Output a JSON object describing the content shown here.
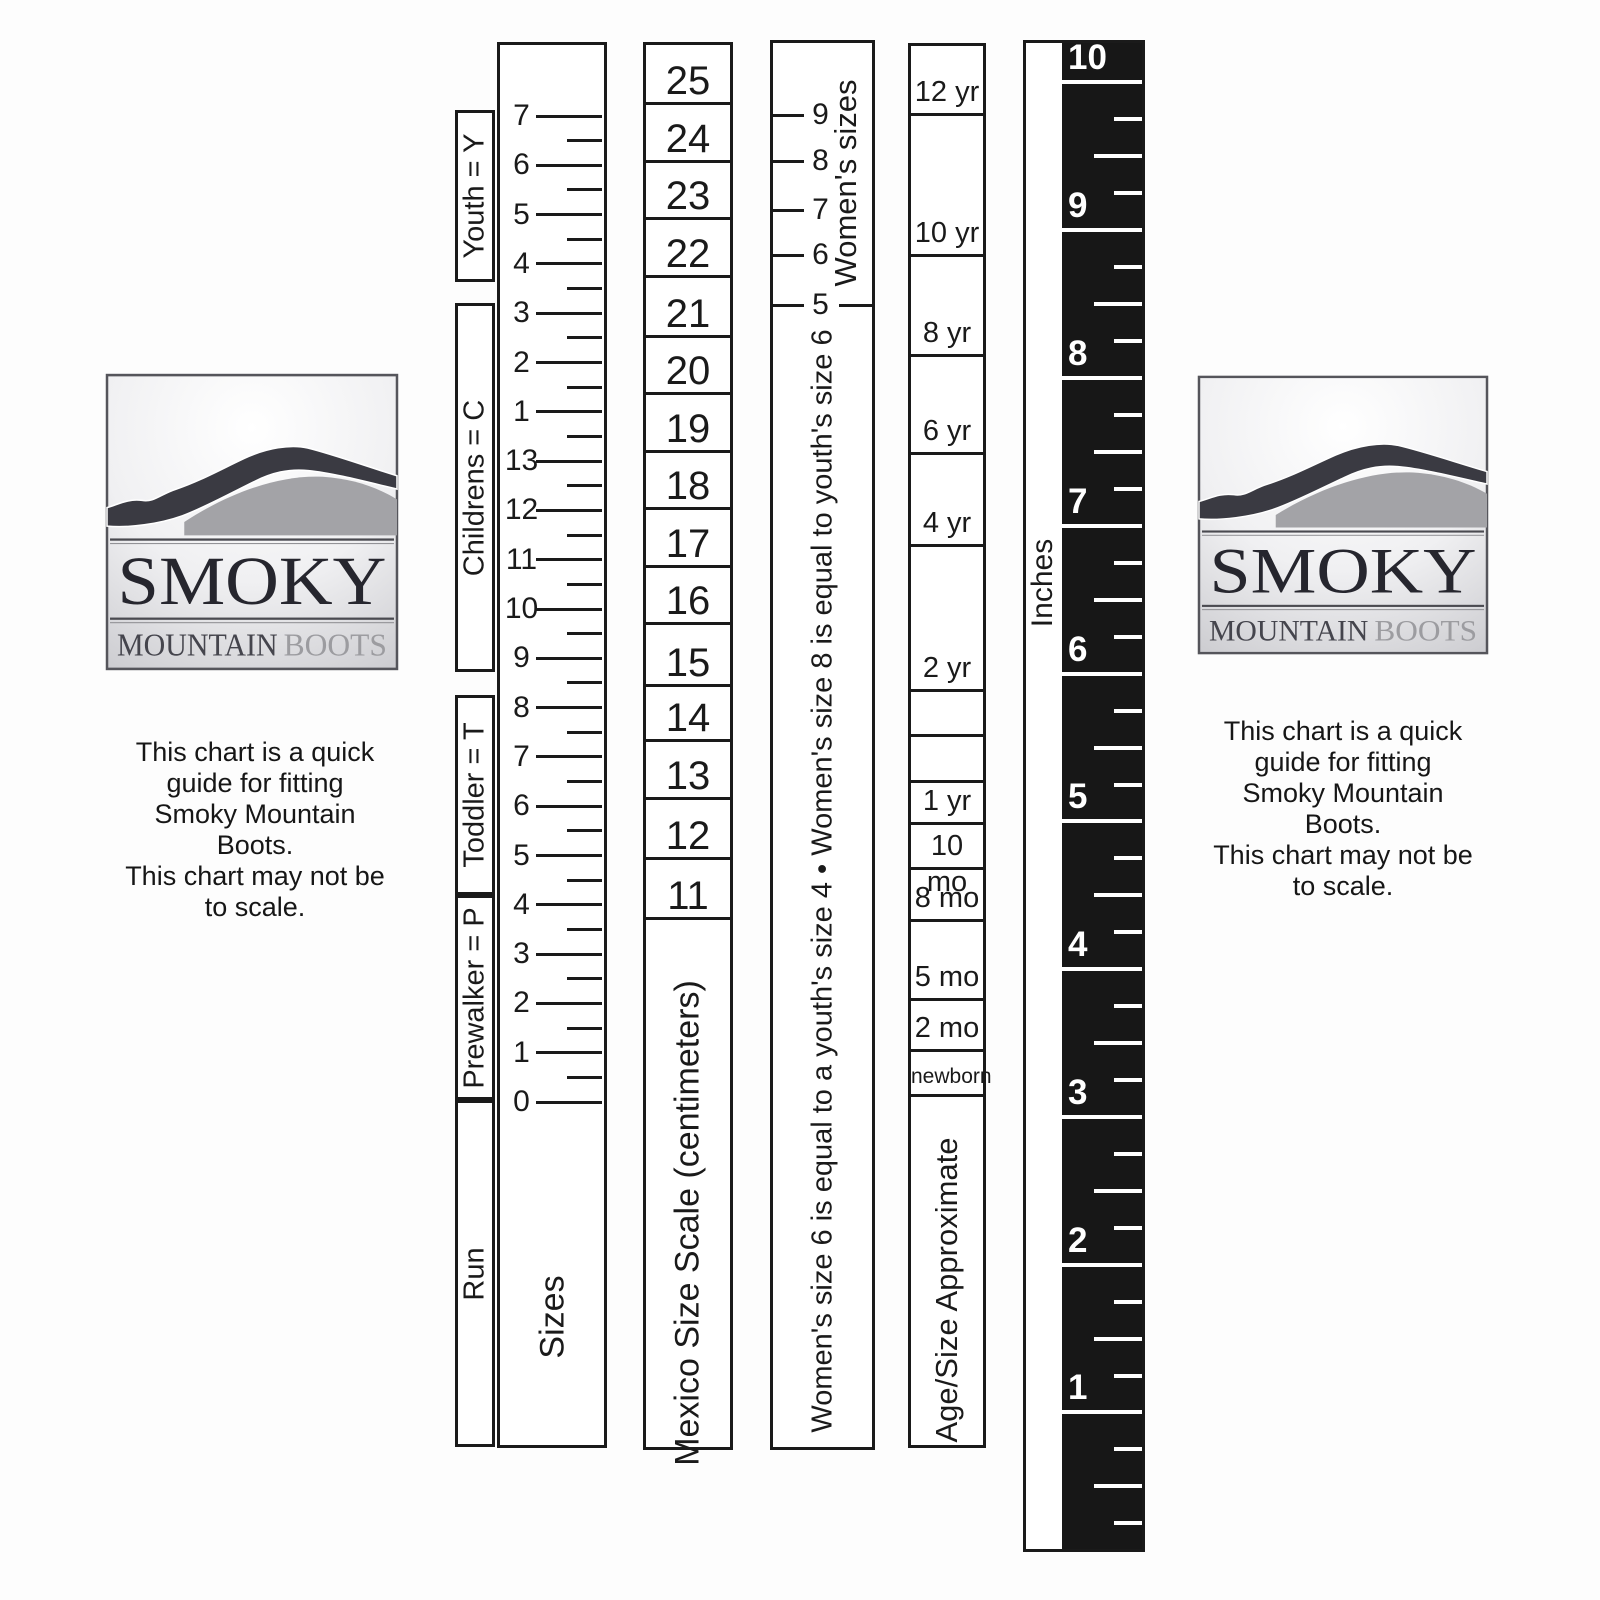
{
  "page": {
    "background": "#fdfdfd",
    "ink": "#1a1a1a",
    "ruler_black": "#171717"
  },
  "logo": {
    "title": "SMOKY",
    "subtitle_dark": "MOUNTAIN",
    "subtitle_light": "BOOTS"
  },
  "note": {
    "lines": [
      "This chart is a quick",
      "guide for fitting",
      "Smoky Mountain",
      "Boots.",
      "This chart may not be",
      "to scale."
    ]
  },
  "size_chart": {
    "sizes_label": "Sizes",
    "run_label": "Run",
    "brackets": [
      {
        "label": "Youth = Y",
        "top": 110,
        "height": 172
      },
      {
        "label": "Childrens = C",
        "top": 303,
        "height": 369
      },
      {
        "label": "Toddler = T",
        "top": 695,
        "height": 200
      },
      {
        "label": "Prewalker = P",
        "top": 895,
        "height": 205
      },
      {
        "label": "Run",
        "top": 1100,
        "height": 347
      }
    ],
    "major_ticks": [
      "7",
      "6",
      "5",
      "4",
      "3",
      "2",
      "1",
      "13",
      "12",
      "11",
      "10",
      "9",
      "8",
      "7",
      "6",
      "5",
      "4",
      "3",
      "2",
      "1",
      "0"
    ],
    "tick_start_y": 113,
    "tick_spacing": 49.3
  },
  "mexico": {
    "label": "Mexico Size Scale (centimeters)",
    "values": [
      "25",
      "24",
      "23",
      "22",
      "21",
      "20",
      "19",
      "18",
      "17",
      "16",
      "15",
      "14",
      "13",
      "12",
      "11"
    ],
    "cell_boundaries": [
      42,
      100,
      158,
      215,
      273,
      333,
      390,
      448,
      505,
      563,
      620,
      682,
      737,
      795,
      855,
      915
    ]
  },
  "womens": {
    "header_label": "Women's sizes",
    "ticks": [
      {
        "label": "9",
        "y": 112
      },
      {
        "label": "8",
        "y": 158
      },
      {
        "label": "7",
        "y": 207
      },
      {
        "label": "6",
        "y": 252
      }
    ],
    "divider": {
      "label": "5",
      "y": 302
    },
    "note": "Women's size 6 is equal to a youth's size 4 • Women's size 8 is equal to youth's size 6"
  },
  "age": {
    "label": "Age/Size Approximate",
    "cells": [
      {
        "label": "12 yr",
        "top": 43,
        "bottom": 111
      },
      {
        "label": "10 yr",
        "top": 111,
        "bottom": 252
      },
      {
        "label": "8 yr",
        "top": 252,
        "bottom": 352
      },
      {
        "label": "6 yr",
        "top": 352,
        "bottom": 450
      },
      {
        "label": "4 yr",
        "top": 450,
        "bottom": 542
      },
      {
        "label": "2 yr",
        "top": 542,
        "bottom": 687
      },
      {
        "label": "",
        "top": 687,
        "bottom": 732
      },
      {
        "label": "",
        "top": 732,
        "bottom": 778
      },
      {
        "label": "1 yr",
        "top": 778,
        "bottom": 820
      },
      {
        "label": "10 mo",
        "top": 820,
        "bottom": 865
      },
      {
        "label": "8 mo",
        "top": 865,
        "bottom": 917
      },
      {
        "label": "5 mo",
        "top": 917,
        "bottom": 996
      },
      {
        "label": "2 mo",
        "top": 996,
        "bottom": 1047
      },
      {
        "label": "newborn",
        "top": 1047,
        "bottom": 1092
      }
    ]
  },
  "ruler": {
    "label": "Inches",
    "numbers": [
      "10",
      "9",
      "8",
      "7",
      "6",
      "5",
      "4",
      "3",
      "2",
      "1"
    ]
  }
}
